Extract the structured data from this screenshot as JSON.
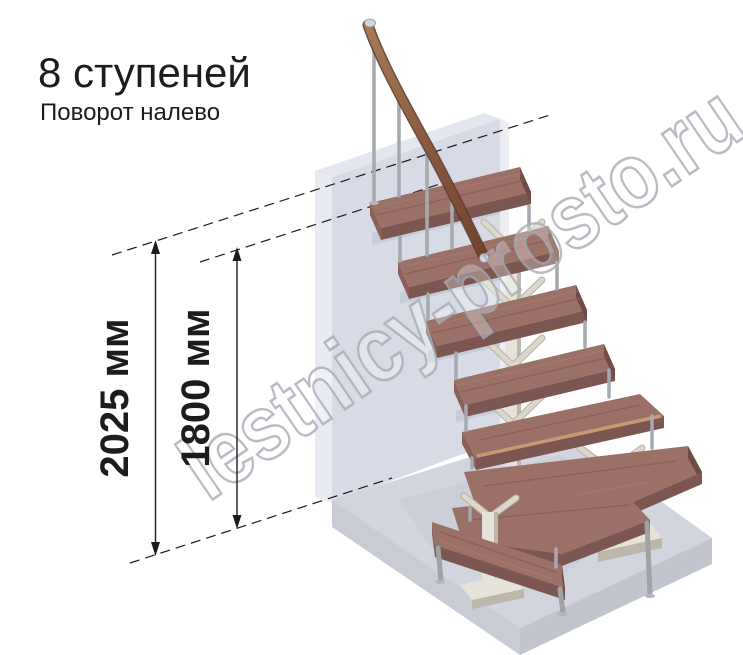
{
  "header": {
    "title": "8 ступеней",
    "subtitle": "Поворот налево"
  },
  "dimensions": {
    "total_height": {
      "label": "2025 мм"
    },
    "partial_height": {
      "label": "1800 мм"
    }
  },
  "watermark": {
    "text": "lestnicy-prosto.ru"
  },
  "colors": {
    "annotation": "#1c1c1c",
    "wood": "#9b7066",
    "wood_dark": "#7c5650",
    "wood_side": "#6f4c46",
    "metal": "#a6a9ad",
    "wall": "#d8dbe5",
    "wall_top": "#e4e7ef",
    "floor": "#d2d5dd",
    "support": "#e6e2d8",
    "handrail": "#8a5a40",
    "nose_accent": "#c79a72",
    "watermark": "#a8adb5"
  }
}
